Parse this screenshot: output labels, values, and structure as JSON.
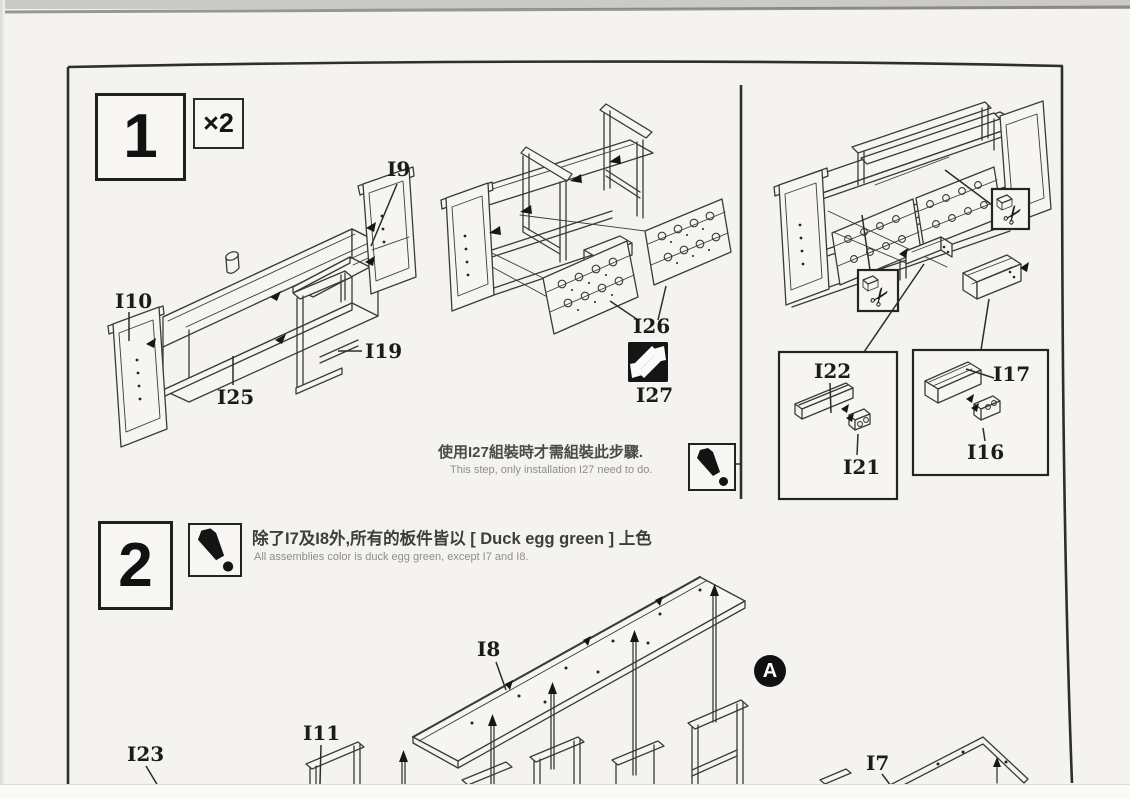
{
  "labels": {
    "i9": "I9",
    "i10": "I10",
    "i25": "I25",
    "i19": "I19",
    "i26": "I26",
    "i27": "I27",
    "i22": "I22",
    "i21": "I21",
    "i17": "I17",
    "i16": "I16",
    "i8": "I8",
    "i11": "I11",
    "i23": "I23",
    "i7": "I7"
  },
  "step1": {
    "number": "1",
    "multiplier_label": "×2",
    "note_zh": "使用I27組裝時才需組裝此步驟.",
    "note_en": "This step, only installation I27 need to do."
  },
  "step2": {
    "number": "2",
    "note_zh": "除了I7及I8外,所有的板件皆以 [ Duck egg green ] 上色",
    "note_en": "All assemblies color is duck egg green, except I7 and I8.",
    "view_marker": "A"
  },
  "icons": {
    "exclamation": "exclamation-icon",
    "scissors": "scissors-icon",
    "scissors_glyph": "✂",
    "interchange": "interchange-arrows-icon"
  },
  "colors": {
    "ink": "#2b2b2b",
    "paper": "#f4f3ef"
  }
}
